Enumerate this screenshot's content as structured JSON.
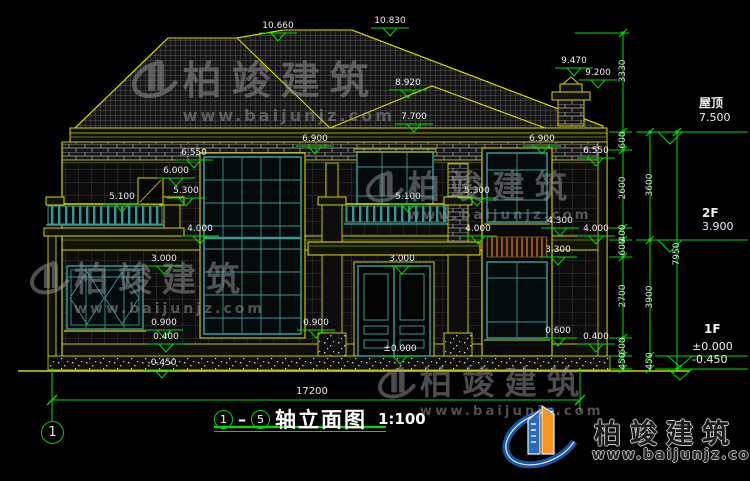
{
  "drawing": {
    "type": "architectural-elevation",
    "overall_width_dim": "17200",
    "title": {
      "axis_from": "1",
      "axis_to": "5",
      "name": "轴立面图",
      "scale": "1:100"
    },
    "axis_bubble": "1"
  },
  "floor_levels": [
    {
      "name": "屋顶",
      "value": "7.500"
    },
    {
      "name": "2F",
      "value": "3.900"
    },
    {
      "name": "1F",
      "value": "±0.000",
      "extra": "-0.450"
    }
  ],
  "elevation_markers": [
    {
      "label": "10.660",
      "x": 256,
      "y": 33
    },
    {
      "label": "10.830",
      "x": 368,
      "y": 28
    },
    {
      "label": "9.470",
      "x": 552,
      "y": 68
    },
    {
      "label": "9.200",
      "x": 576,
      "y": 80
    },
    {
      "label": "8.920",
      "x": 386,
      "y": 90
    },
    {
      "label": "7.700",
      "x": 392,
      "y": 124
    },
    {
      "label": "6.900",
      "x": 293,
      "y": 146
    },
    {
      "label": "6.900",
      "x": 520,
      "y": 146
    },
    {
      "label": "6.550",
      "x": 172,
      "y": 160
    },
    {
      "label": "6.550",
      "x": 574,
      "y": 158
    },
    {
      "label": "6.000",
      "x": 154,
      "y": 178
    },
    {
      "label": "5.300",
      "x": 164,
      "y": 198
    },
    {
      "label": "5.300",
      "x": 455,
      "y": 198
    },
    {
      "label": "5.100",
      "x": 100,
      "y": 204
    },
    {
      "label": "5.100",
      "x": 386,
      "y": 204
    },
    {
      "label": "4.300",
      "x": 538,
      "y": 228
    },
    {
      "label": "4.000",
      "x": 178,
      "y": 236
    },
    {
      "label": "4.000",
      "x": 456,
      "y": 236
    },
    {
      "label": "4.000",
      "x": 574,
      "y": 236
    },
    {
      "label": "3.300",
      "x": 536,
      "y": 257
    },
    {
      "label": "3.000",
      "x": 142,
      "y": 266
    },
    {
      "label": "3.000",
      "x": 380,
      "y": 266
    },
    {
      "label": "0.900",
      "x": 142,
      "y": 330
    },
    {
      "label": "0.900",
      "x": 294,
      "y": 330
    },
    {
      "label": "0.600",
      "x": 536,
      "y": 338
    },
    {
      "label": "0.400",
      "x": 144,
      "y": 344
    },
    {
      "label": "0.400",
      "x": 574,
      "y": 344
    },
    {
      "label": "±0.000",
      "x": 378,
      "y": 356
    },
    {
      "label": "-0.450",
      "x": 140,
      "y": 370
    }
  ],
  "dimension_chains": [
    {
      "x": 623,
      "top": 33,
      "bottom": 369,
      "ticks": [
        33,
        132,
        150,
        228,
        240,
        257,
        338,
        356,
        369
      ],
      "labels": [
        {
          "text": "3330",
          "y": 72
        },
        {
          "text": "600",
          "y": 141
        },
        {
          "text": "2600",
          "y": 189
        },
        {
          "text": "400",
          "y": 234
        },
        {
          "text": "600",
          "y": 248
        },
        {
          "text": "2700",
          "y": 297
        },
        {
          "text": "600",
          "y": 347
        },
        {
          "text": "450",
          "y": 362
        }
      ]
    },
    {
      "x": 650,
      "top": 132,
      "bottom": 369,
      "ticks": [
        132,
        240,
        356,
        369
      ],
      "labels": [
        {
          "text": "3600",
          "y": 186
        },
        {
          "text": "3900",
          "y": 298
        },
        {
          "text": "450",
          "y": 362
        }
      ]
    },
    {
      "x": 677,
      "top": 132,
      "bottom": 369,
      "ticks": [
        132,
        369
      ],
      "labels": [
        {
          "text": "7950",
          "y": 255
        }
      ]
    }
  ],
  "bottom_dimension": {
    "label": "17200",
    "y": 400,
    "x1": 52,
    "x2": 580
  },
  "watermark": {
    "text": "柏竣建筑",
    "url": "www.baijunjz.com"
  },
  "brand_logo": {
    "text": "柏竣建筑",
    "url": "www.baijunjz.com",
    "blue": "#1656a8",
    "orange": "#f7941e"
  },
  "colors": {
    "cad_yellow": "#d6d600",
    "dim_green": "#00dd00",
    "window_teal": "#3a9494",
    "louver_brown": "#8a5420"
  }
}
